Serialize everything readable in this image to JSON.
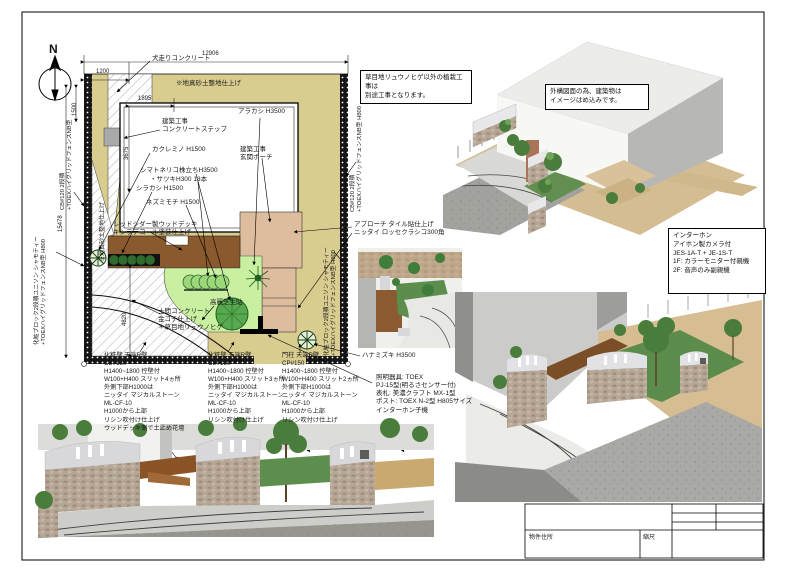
{
  "sheet": {
    "north_label": "N",
    "dims": {
      "top_overall": "12906",
      "top_offset": "1200",
      "left_small": "1500",
      "step_w": "1895",
      "step_h": "3675",
      "left_overall": "15478",
      "left_lower": "4820"
    },
    "notes": {
      "planting": "草目地リュウノヒゲ以外の植栽工事は\n別途工事となります。",
      "building": "外構図面の為、建築物は\nイメージはめ込みです。",
      "intercom": "インターホン\nアイホン製カメラ付\nJES-1A-T + JE-1S-T\n1F: カラーモニター付親機\n2F: 音声のみ副親機"
    },
    "plan_labels": {
      "inubashiri": "犬走りコンクリート",
      "masado": "※地真砂土整地仕上げ",
      "masado_side": "※地真砂土整地仕上げ",
      "step": "建築工事\nコンクリートステップ",
      "porch": "建築工事\n玄関ポーチ",
      "arakashi": "アラカシ H3500",
      "kakuremino": "カクレミノ H1500",
      "shimatoneriko": "シマトネリコ株立ちH3500",
      "satsuki": "・サツキH300 13本",
      "shirakashi": "シラカシ H1500",
      "nezumimochi": "ネズミモチ H1500",
      "deck": "レッドシダー製ウッドデッキ\nキシラデコール塗装仕上げ",
      "approach": "アプローチ タイル貼仕上げ\nニッタイ ロッセクラシコ300角",
      "doma": "土間コンクリート\n金コテ仕上げ\n＊草目地リュウノヒゲ",
      "lawn": "高麗芝生貼",
      "hanamizuki": "ハナミズキ H3500",
      "lighting": "照明器具: TOEX\nPJ-15型(明るさセンサー付)\n表札: 美濃クラフト MX-1型\nポスト: TOEX N-2型 H805サイズ\nインターホン子機"
    },
    "fence_labels": {
      "left_upper": "CB#120 2段積\n+TOEXハイグリッドフェンスNB型",
      "left_lower": "化粧ブロック2段積ユニソン シャモティー\n+TOEXハイグリッドフェンスNB型 H800",
      "right_upper": "CB#120 2段積\n+TOEXハイグリッドフェンスNB型 H800",
      "right_lower": "化粧ブロック2段積ユニソン シャモティー\n+TOEXハイグリッドフェンスNB型 H800"
    },
    "spec_blocks": [
      "化粧壁 天端R壁\nCB#150\nH1400~1800 控壁付\nW100+H400 スリット4ヵ所\n外側下部H1000は\nニッタイ マジカルストーン\nML-CF-10\nH1000から上部\nリシン吹付け仕上げ\nウッドデッキ側で土止め花壇",
      "化粧壁 天端R壁\nCB#150\nH1400~1800 控壁付\nW100+H400 スリット3ヵ所\n外側下部H1000は\nニッタイ マジカルストーン\nML-CF-10\nH1000から上部\nリシン吹付け仕上げ",
      "門柱 天端R壁\nCP#150\nH1400~1800 控壁付\nW100+H400 スリット2ヵ所\n外側下部H1000は\nニッタイ マジカルストーン\nML-CF-10\nH1000から上部\nリシン吹付け仕上げ"
    ],
    "title_block": {
      "address_label": "物件住所",
      "scale_label": "縮尺"
    },
    "colors": {
      "masado_soil": "#d9cc8f",
      "wood_deck": "#8a5a2e",
      "approach_tile": "#ddbd9d",
      "lawn": "#c9f0a1",
      "tree_green": "#3f7d3a",
      "concrete": "#d3d3cf",
      "road_grey": "#a5a5a1"
    }
  }
}
